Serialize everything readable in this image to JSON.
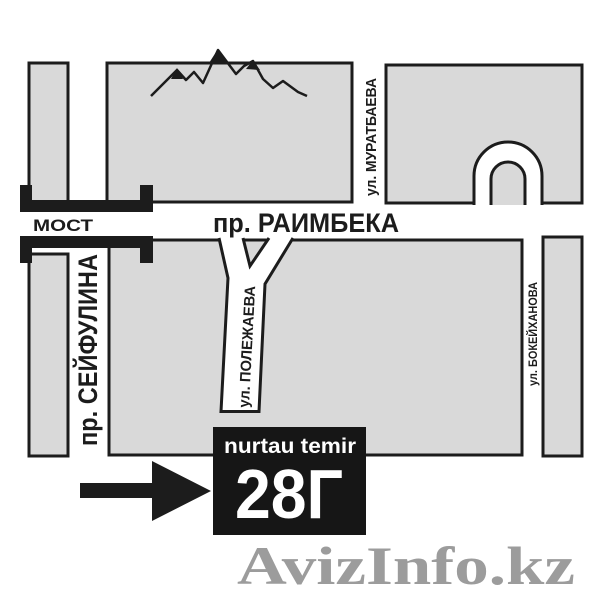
{
  "map": {
    "streets": {
      "raimbek": "пр. РАИМБЕКА",
      "seifullin": "пр. СЕЙФУЛИНА",
      "muratbaev": "ул. МУРАТБАЕВА",
      "polezhaev": "ул. ПОЛЕЖАЕВА",
      "bokeikhanov": "ул. БОКЕЙХАНОВА"
    },
    "bridge_label": "МОСТ",
    "marker": {
      "name": "nurtau temir",
      "address_number": "28Г"
    },
    "icons": {
      "mountains": "mountain-range-silhouette",
      "arrow": "solid-right-arrow",
      "bridge": "bridge-brackets"
    },
    "colors": {
      "ink": "#1c1c1c",
      "block": "#d9d9d9",
      "road": "#ffffff",
      "marker_bg": "#161616",
      "marker_text": "#ffffff",
      "watermark": "#9c9c9c"
    }
  },
  "watermark": {
    "text": "AvizInfo.kz"
  }
}
